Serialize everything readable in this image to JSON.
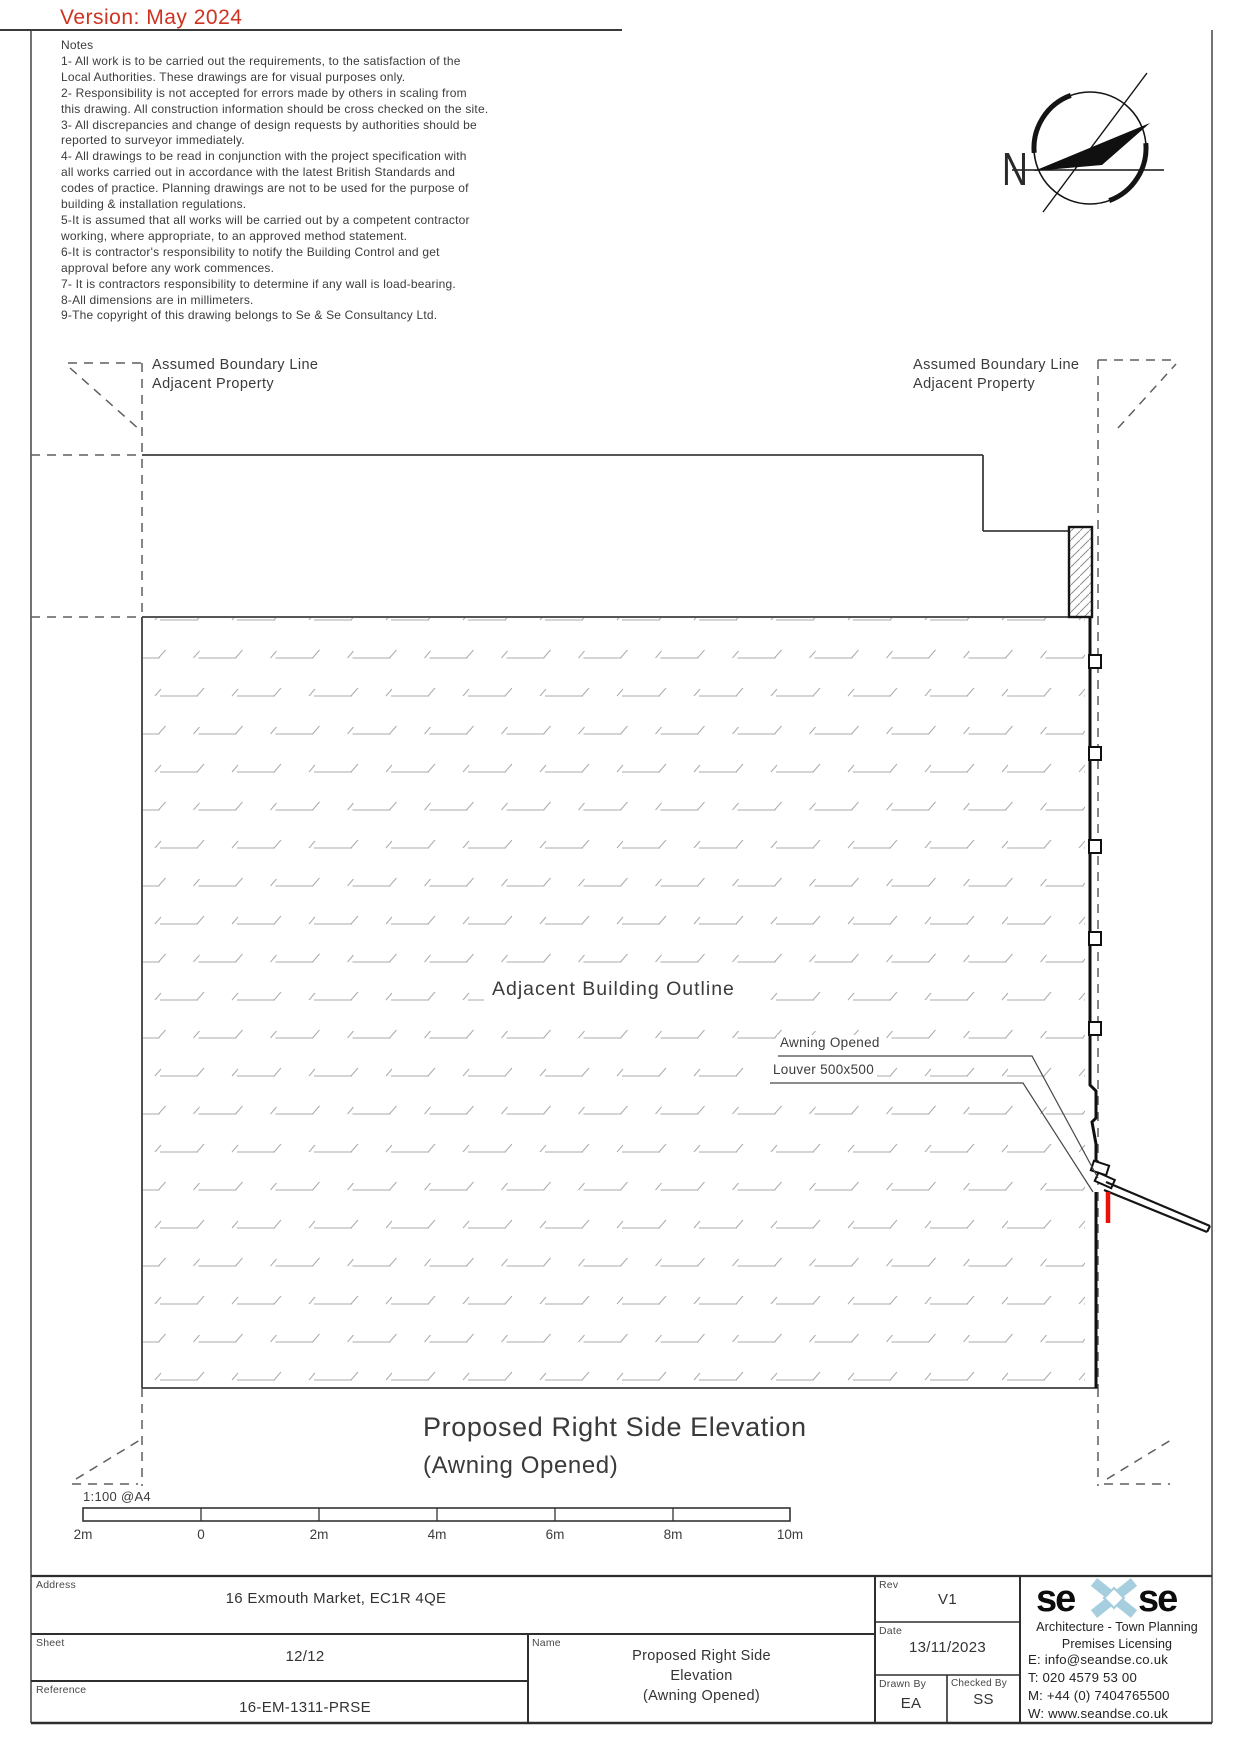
{
  "version_banner": "Version: May 2024",
  "notes": {
    "title": "Notes",
    "lines": [
      "1- All work is to be carried out the requirements, to the satisfaction of the",
      "Local Authorities. These drawings are for visual purposes only.",
      "2- Responsibility is not accepted for errors made by others in scaling from",
      "this drawing. All construction information should be cross checked on the site.",
      "3- All discrepancies and change of design requests by authorities should be",
      "reported to surveyor immediately.",
      "4- All drawings to be read in conjunction with the project specification with",
      "all works carried out in accordance with the latest British Standards and",
      "codes of practice. Planning drawings are not to be used for the purpose of",
      "building & installation regulations.",
      "5-It is assumed that all works will be carried out by a competent contractor",
      "working, where appropriate, to an approved method statement.",
      "6-It is contractor's responsibility to notify the Building Control and get",
      "approval before any work commences.",
      "7- It is contractors responsibility to determine if any wall is load-bearing.",
      "8-All dimensions are in millimeters.",
      "9-The copyright of this drawing belongs to Se & Se Consultancy Ltd."
    ]
  },
  "compass": {
    "north_label": "N"
  },
  "boundary_left": {
    "line1": "Assumed Boundary Line",
    "line2": "Adjacent Property"
  },
  "boundary_right": {
    "line1": "Assumed Boundary Line",
    "line2": "Adjacent Property"
  },
  "drawing_labels": {
    "building": "Adjacent Building Outline",
    "awning": "Awning Opened",
    "louver": "Louver 500x500"
  },
  "drawing_title": {
    "line1": "Proposed Right Side Elevation",
    "line2": "(Awning Opened)"
  },
  "scale": {
    "label": "1:100 @A4",
    "ticks": [
      "2m",
      "0",
      "2m",
      "4m",
      "6m",
      "8m",
      "10m"
    ]
  },
  "titleblock": {
    "address_label": "Address",
    "address": "16 Exmouth Market, EC1R 4QE",
    "sheet_label": "Sheet",
    "sheet": "12/12",
    "reference_label": "Reference",
    "reference": "16-EM-1311-PRSE",
    "name_label": "Name",
    "name_lines": [
      "Proposed Right Side",
      "Elevation",
      "(Awning Opened)"
    ],
    "rev_label": "Rev",
    "rev": "V1",
    "date_label": "Date",
    "date": "13/11/2023",
    "drawn_label": "Drawn By",
    "drawn": "EA",
    "checked_label": "Checked By",
    "checked": "SS",
    "firm": {
      "logo_left": "se",
      "logo_right": "se",
      "tagline1": "Architecture - Town Planning",
      "tagline2": "Premises Licensing",
      "email": "E: info@seandse.co.uk",
      "tel": "T: 020 4579 53 00",
      "mobile": "M: +44 (0) 7404765500",
      "web": "W: www.seandse.co.uk"
    }
  },
  "colors": {
    "version_red": "#ce3321",
    "awning_red": "#ea1208",
    "logo_blue": "#a7cede",
    "line_dark": "#3a3a3a"
  }
}
